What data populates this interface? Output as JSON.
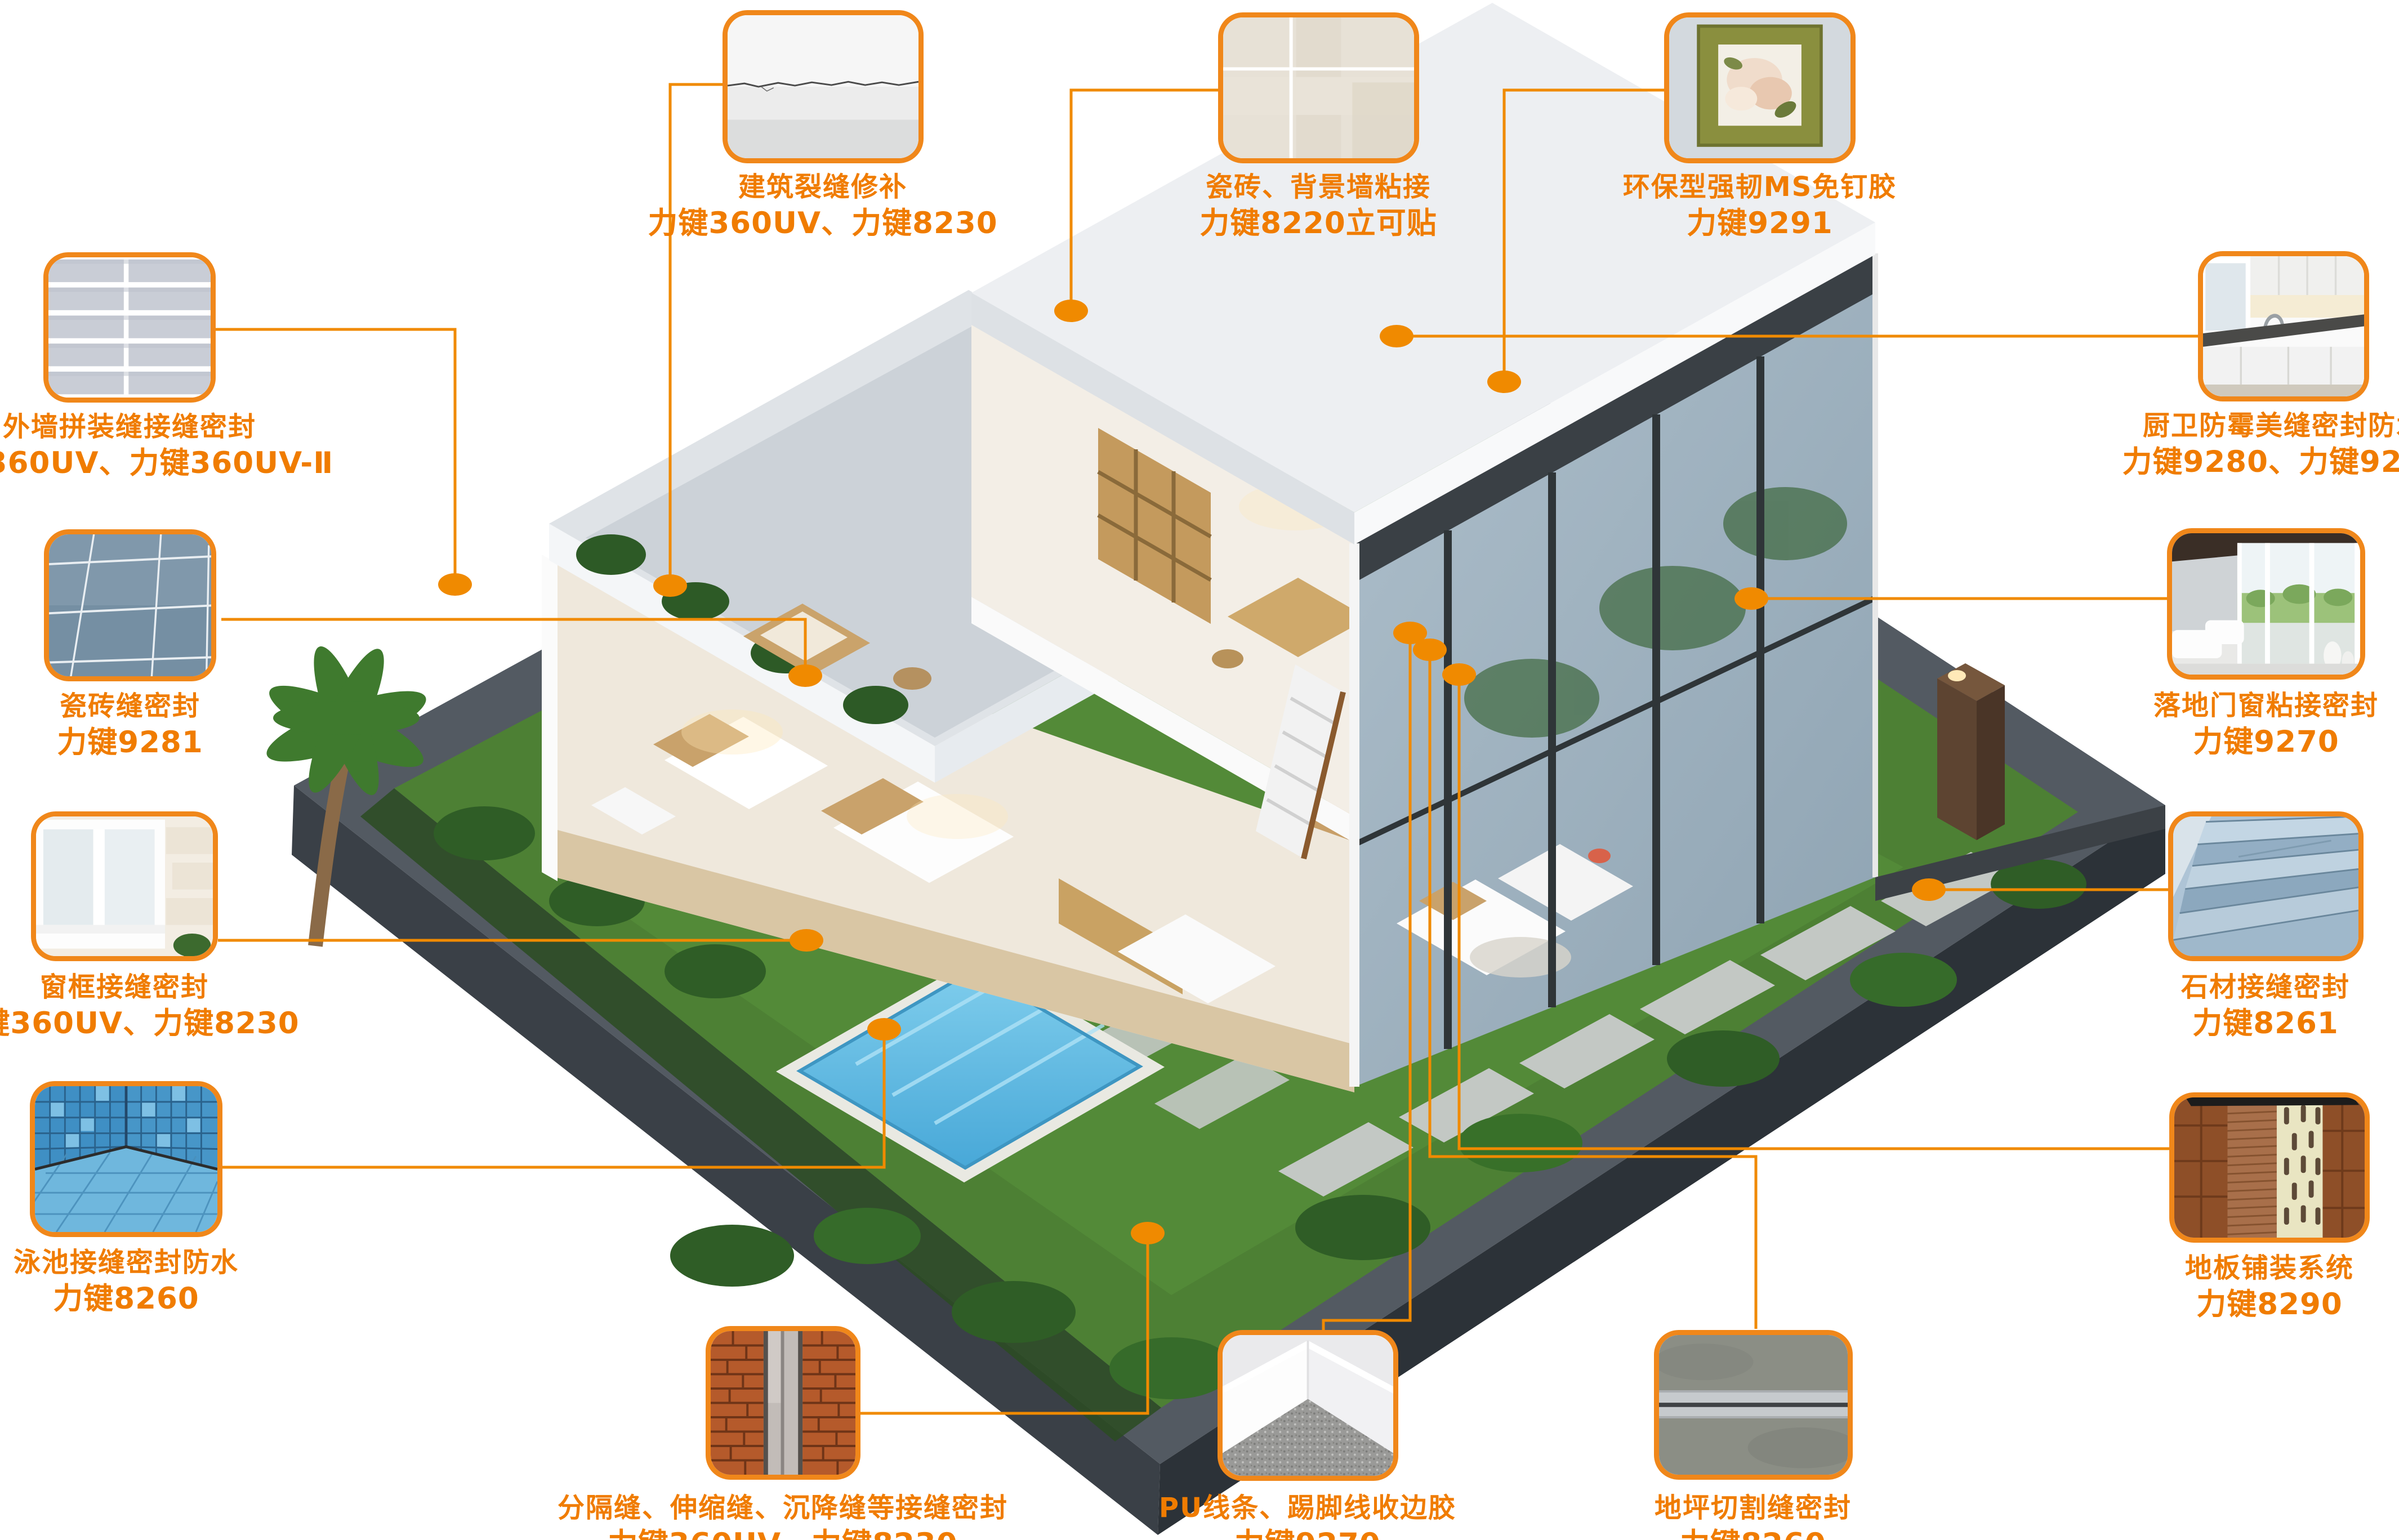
{
  "colors": {
    "accent_line": "#F08A00",
    "accent_border": "#F0871A",
    "accent_text": "#F07C00"
  },
  "scene": {
    "description": "isometric-cutaway-villa-with-garden-pool-deck"
  },
  "callouts": [
    {
      "id": "crack-repair",
      "title": "建筑裂缝修补",
      "products": "力键360UV、力键8230",
      "thumb": "wall-crack"
    },
    {
      "id": "tile-wall-bond",
      "title": "瓷砖、背景墙粘接",
      "products": "力键8220立可贴",
      "thumb": "beige-tile"
    },
    {
      "id": "ms-nail-free-glue",
      "title": "环保型强韧MS免钉胶",
      "products": "力键9291",
      "thumb": "picture-frame"
    },
    {
      "id": "exterior-panel-joint",
      "title": "外墙拼装缝接缝密封",
      "products": "力键360UV、力键360UV-Ⅱ",
      "thumb": "panel-wall"
    },
    {
      "id": "tile-grout-seal",
      "title": "瓷砖缝密封",
      "products": "力键9281",
      "thumb": "blue-tile-floor"
    },
    {
      "id": "window-frame-seal",
      "title": "窗框接缝密封",
      "products": "力键360UV、力键8230",
      "thumb": "white-window"
    },
    {
      "id": "pool-seam-seal",
      "title": "泳池接缝密封防水",
      "products": "力键8260",
      "thumb": "pool-mosaic"
    },
    {
      "id": "kitchen-bath-seal",
      "title": "厨卫防霉美缝密封防水",
      "products": "力键9280、力键9281",
      "thumb": "kitchen-counter"
    },
    {
      "id": "floor-door-bond",
      "title": "落地门窗粘接密封",
      "products": "力键9270",
      "thumb": "glass-door"
    },
    {
      "id": "stone-joint-seal",
      "title": "石材接缝密封",
      "products": "力键8261",
      "thumb": "stone-stairs"
    },
    {
      "id": "floor-paving-system",
      "title": "地板铺装系统",
      "products": "力键8290",
      "thumb": "wood-floor"
    },
    {
      "id": "expansion-joint-seal",
      "title": "分隔缝、伸缩缝、沉降缝等接缝密封",
      "products": "力键360UV、力键8230",
      "thumb": "brick-joint"
    },
    {
      "id": "pu-trim-skirting-glue",
      "title": "PU线条、踢脚线收边胶",
      "products": "力键9270",
      "thumb": "skirting-corner"
    },
    {
      "id": "floor-cut-seam-seal",
      "title": "地坪切割缝密封",
      "products": "力键8260",
      "thumb": "concrete-seam"
    }
  ]
}
